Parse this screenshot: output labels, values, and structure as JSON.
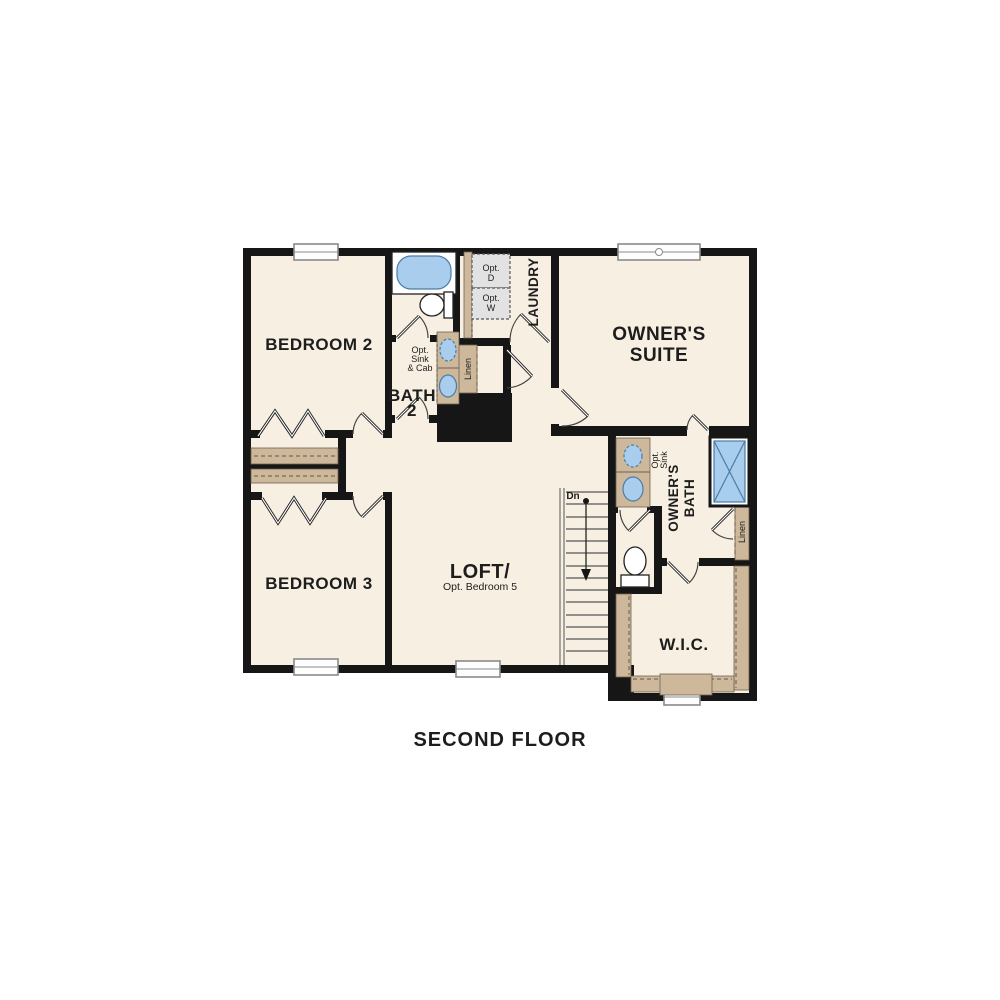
{
  "title": "SECOND FLOOR",
  "plan": {
    "rooms": {
      "bedroom2": "BEDROOM 2",
      "bedroom3": "BEDROOM 3",
      "owners_suite_1": "OWNER'S",
      "owners_suite_2": "SUITE",
      "loft": "LOFT/",
      "loft_sub": "Opt. Bedroom 5",
      "wic": "W.I.C.",
      "bath2_1": "BATH",
      "bath2_2": "2",
      "laundry": "LAUNDRY",
      "owners_bath_1": "OWNER'S",
      "owners_bath_2": "BATH"
    },
    "labels": {
      "opt_d_1": "Opt.",
      "opt_d_2": "D",
      "opt_w_1": "Opt.",
      "opt_w_2": "W",
      "opt_sink_cab_1": "Opt.",
      "opt_sink_cab_2": "Sink",
      "opt_sink_cab_3": "& Cab",
      "opt_sink_1": "Opt.",
      "opt_sink_2": "Sink",
      "linen_hall": "Linen",
      "linen_bath": "Linen",
      "dn": "Dn"
    },
    "colors": {
      "walls": "#161616",
      "floor": "#f7efe2",
      "fixture_blue": "#a9cdec",
      "cabinet_tan": "#cdb89b",
      "appliance_gray": "#e2e2e2"
    }
  }
}
